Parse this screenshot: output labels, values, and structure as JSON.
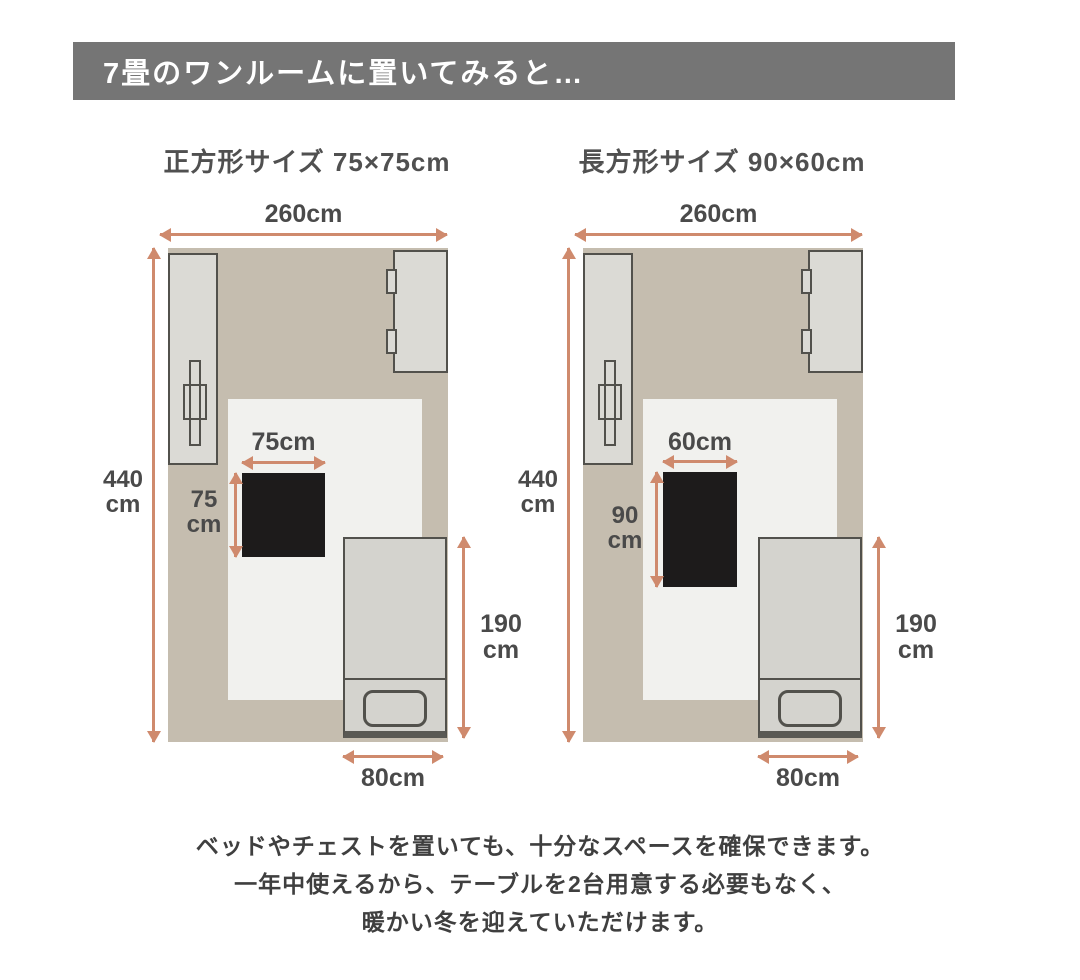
{
  "header": {
    "title": "7畳のワンルームに置いてみると…"
  },
  "diagrams": [
    {
      "title": "正方形サイズ 75×75cm",
      "room_width_label": "260cm",
      "room_height_value": "440",
      "room_height_unit": "cm",
      "table_width_label": "75cm",
      "table_height_value": "75",
      "table_height_unit": "cm",
      "bed_length_value": "190",
      "bed_length_unit": "cm",
      "bed_width_label": "80cm"
    },
    {
      "title": "長方形サイズ 90×60cm",
      "room_width_label": "260cm",
      "room_height_value": "440",
      "room_height_unit": "cm",
      "table_width_label": "60cm",
      "table_height_value": "90",
      "table_height_unit": "cm",
      "bed_length_value": "190",
      "bed_length_unit": "cm",
      "bed_width_label": "80cm"
    }
  ],
  "footer": {
    "lines": [
      "ベッドやチェストを置いても、十分なスペースを確保できます。",
      "一年中使えるから、テーブルを2台用意する必要もなく、",
      "暖かい冬を迎えていただけます。"
    ]
  },
  "colors": {
    "header_bg": "#757575",
    "room_floor": "#c5bdaf",
    "rug": "#f1f1ee",
    "furniture_fill": "#dbdad5",
    "furniture_border": "#52514c",
    "table": "#1d1b1b",
    "arrow": "#cf8a6d",
    "label_text": "#4a4a4a"
  }
}
